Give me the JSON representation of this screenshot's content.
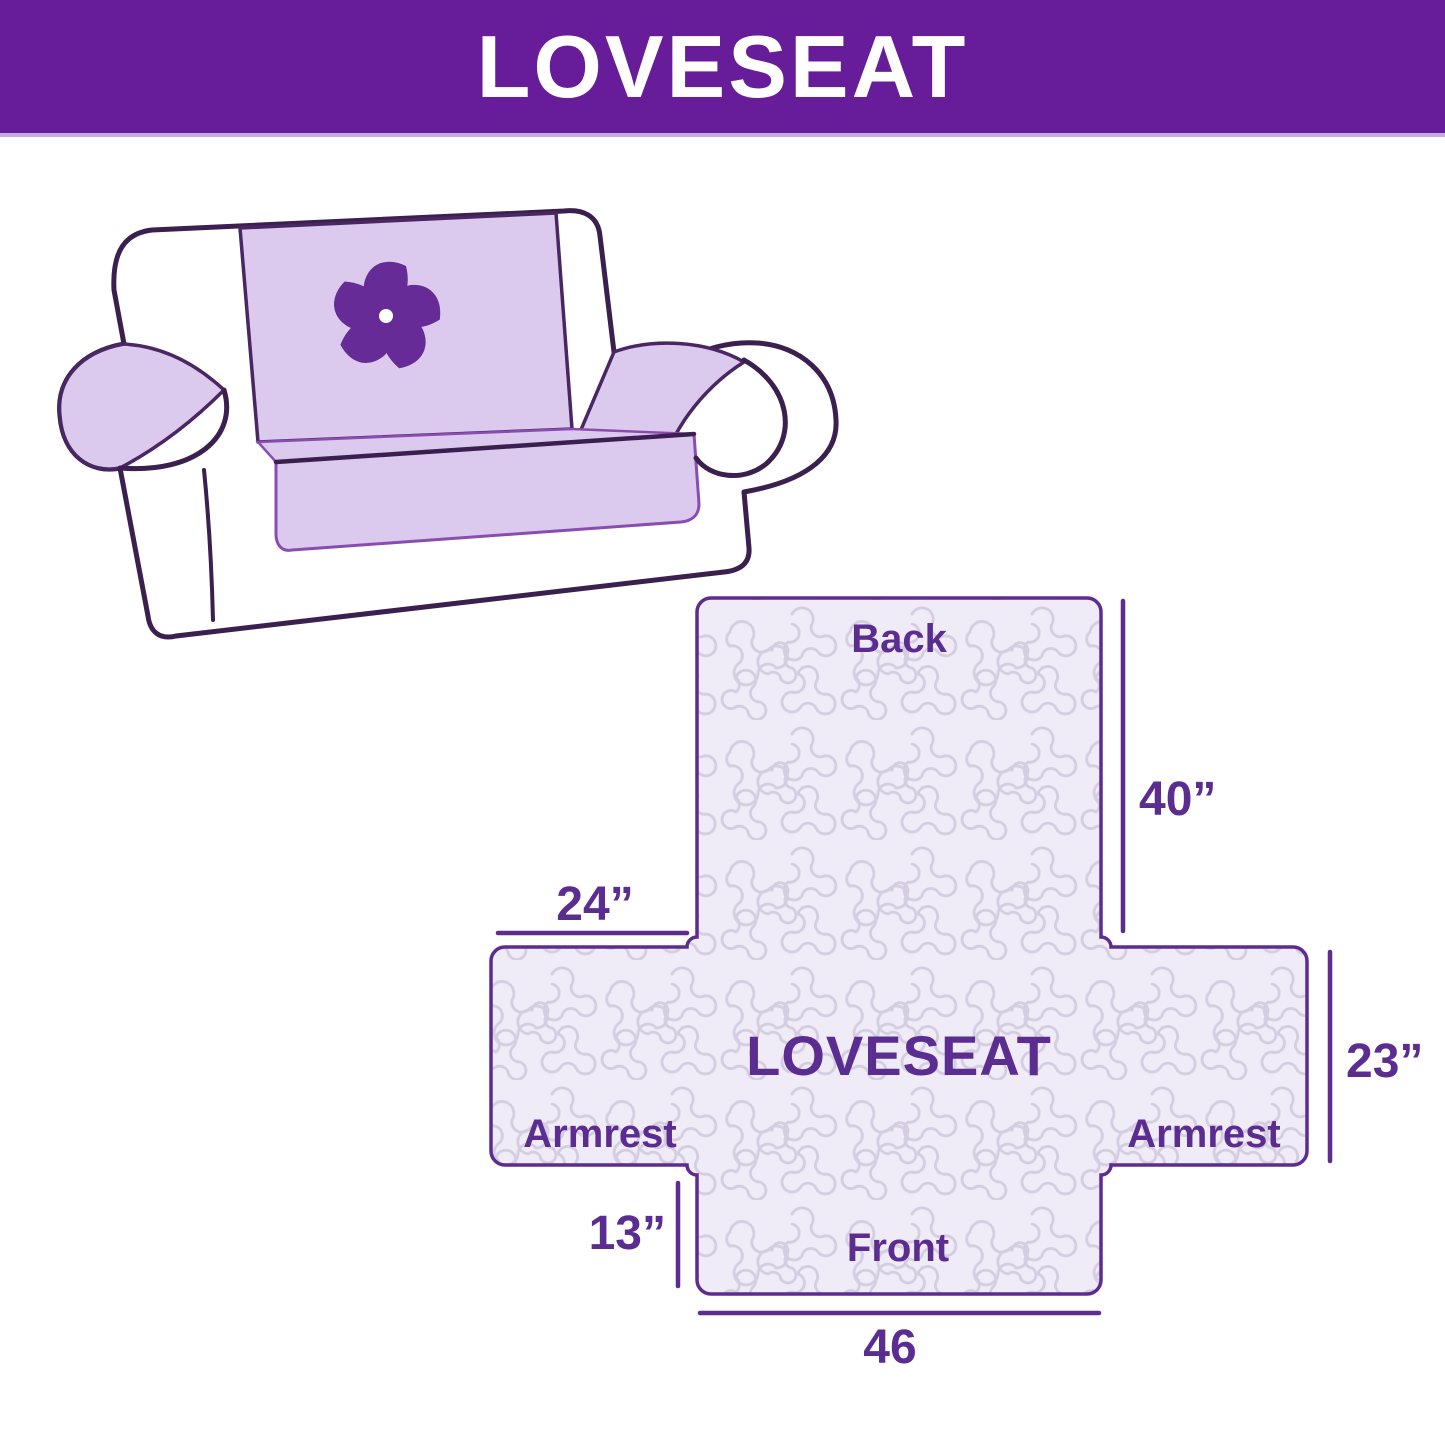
{
  "header": {
    "title": "LOVESEAT",
    "background_color": "#671c9a",
    "text_color": "#ffffff",
    "divider_color": "#c9a9e2"
  },
  "illustration": {
    "subject": "loveseat sofa with protective cover",
    "logo_icon": "pinwheel-logo",
    "cover_color": "#dccaee",
    "outline_color": "#3b1f4e",
    "logo_color": "#662b96"
  },
  "diagram": {
    "center_label": "LOVESEAT",
    "panels": {
      "back": "Back",
      "front": "Front",
      "armrest_left": "Armrest",
      "armrest_right": "Armrest"
    },
    "dimensions": {
      "back_height": "40”",
      "armrest_top_width": "24”",
      "armrest_side_height": "23”",
      "front_drop_height": "13”",
      "front_width": "46"
    },
    "fill_color": "#efebf7",
    "pattern_line_color": "#d5cde0",
    "outline_color": "#5e2b8f",
    "label_color": "#5b2d90"
  }
}
